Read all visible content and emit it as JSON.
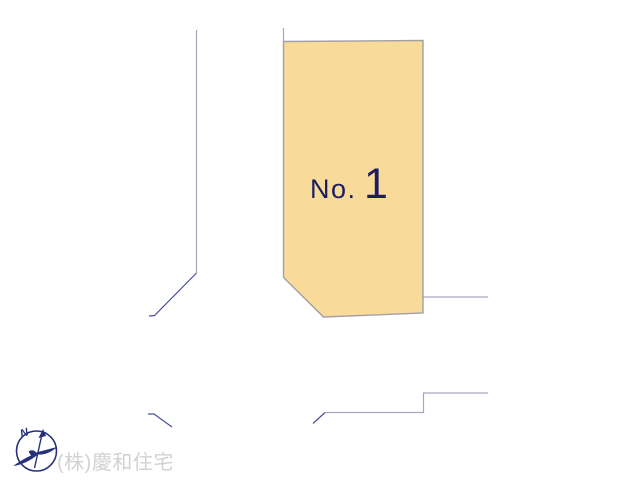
{
  "diagram": {
    "lot": {
      "label_prefix": "No.",
      "number": "1"
    },
    "company_credit": "(株)慶和住宅",
    "compass": {
      "north_label": "N"
    }
  },
  "colors": {
    "background": "#ffffff",
    "lot_fill": "#f8db98",
    "lot_stroke": "#a49ea6",
    "road_line": "#a5a8bd",
    "road_line_dark": "#4b509b",
    "lot_label": "#1b1c64",
    "compass": "#27307c",
    "company_credit": "#d2d2d2"
  }
}
